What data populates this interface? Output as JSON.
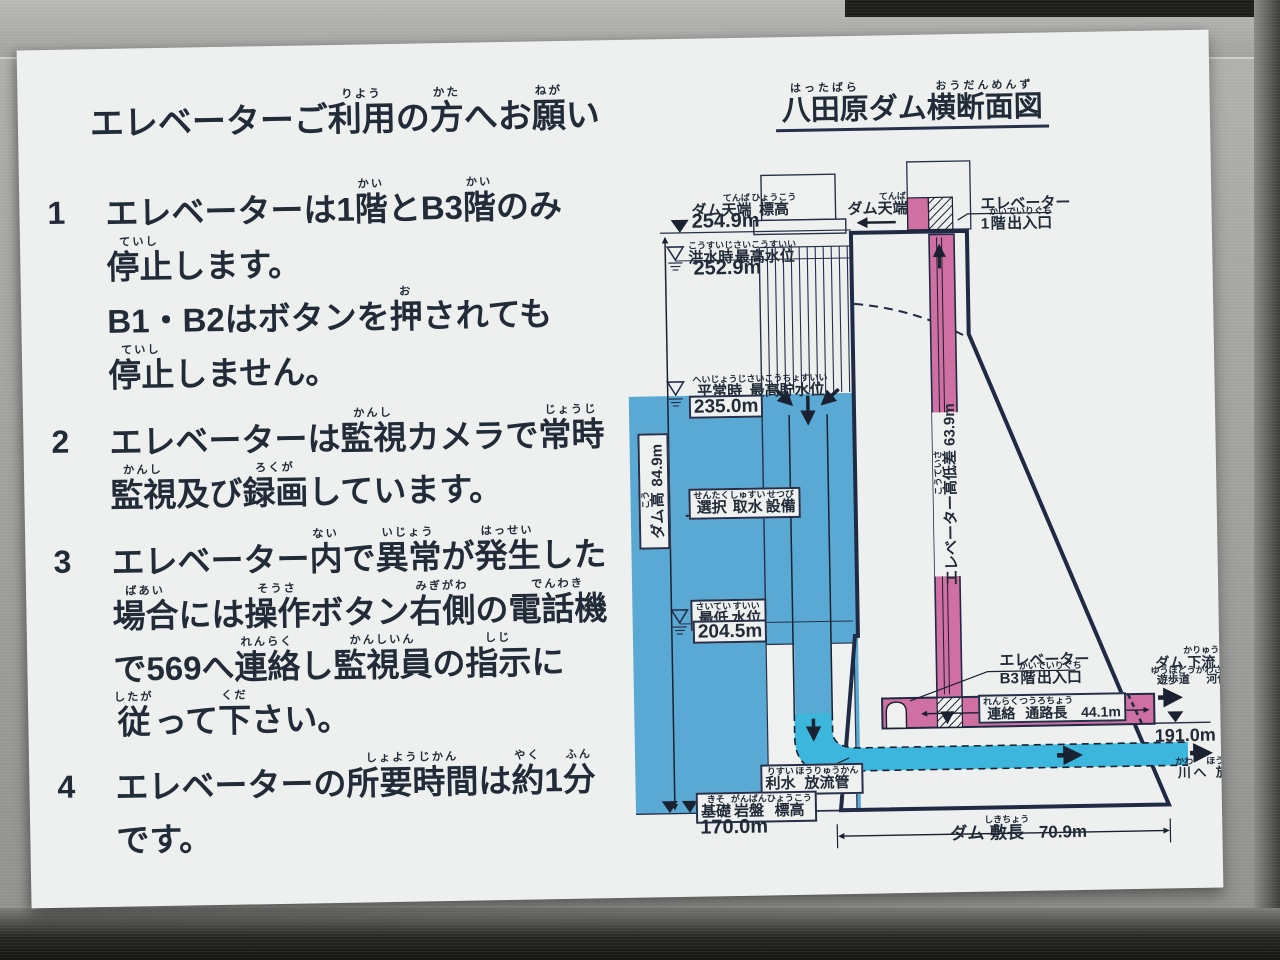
{
  "colors": {
    "water": "#5aa9d4",
    "pipe": "#3db6de",
    "pink": "#cf6fa2",
    "ink": "#222c38",
    "outline": "#1f2a45",
    "card": "#edf0ee"
  },
  "notice": {
    "title": [
      [
        "エレベーターご",
        ""
      ],
      [
        "利用",
        "りよう"
      ],
      [
        "の",
        ""
      ],
      [
        "方",
        "かた"
      ],
      [
        "へお",
        ""
      ],
      [
        "願",
        "ねが"
      ],
      [
        "い",
        ""
      ]
    ],
    "items": [
      {
        "num": "1",
        "lines": [
          [
            [
              "エレベーターは1",
              ""
            ],
            [
              "階",
              "かい"
            ],
            [
              "とB3",
              ""
            ],
            [
              "階",
              "かい"
            ],
            [
              "のみ",
              ""
            ]
          ],
          [
            [
              "停止",
              "ていし"
            ],
            [
              "します。",
              ""
            ]
          ],
          [
            [
              "B1・B2はボタンを",
              ""
            ],
            [
              "押",
              "お"
            ],
            [
              "されても",
              ""
            ]
          ],
          [
            [
              "停止",
              "ていし"
            ],
            [
              "しません。",
              ""
            ]
          ]
        ]
      },
      {
        "num": "2",
        "lines": [
          [
            [
              "エレベーターは",
              ""
            ],
            [
              "監視",
              "かんし"
            ],
            [
              "カメラで",
              ""
            ],
            [
              "常時",
              "じょうじ"
            ]
          ],
          [
            [
              "監視",
              "かんし"
            ],
            [
              "及び",
              ""
            ],
            [
              "録画",
              "ろくが"
            ],
            [
              "しています。",
              ""
            ]
          ]
        ]
      },
      {
        "num": "3",
        "lines": [
          [
            [
              "エレベーター",
              ""
            ],
            [
              "内",
              "ない"
            ],
            [
              "で",
              ""
            ],
            [
              "異常",
              "いじょう"
            ],
            [
              "が",
              ""
            ],
            [
              "発生",
              "はっせい"
            ],
            [
              "した",
              ""
            ]
          ],
          [
            [
              "場合",
              "ばあい"
            ],
            [
              "には",
              ""
            ],
            [
              "操作",
              "そうさ"
            ],
            [
              "ボタン",
              ""
            ],
            [
              "右側",
              "みぎがわ"
            ],
            [
              "の",
              ""
            ],
            [
              "電話機",
              "でんわき"
            ]
          ],
          [
            [
              "で569へ",
              ""
            ],
            [
              "連絡",
              "れんらく"
            ],
            [
              "し",
              ""
            ],
            [
              "監視員",
              "かんしいん"
            ],
            [
              "の",
              ""
            ],
            [
              "指示",
              "しじ"
            ],
            [
              "に",
              ""
            ]
          ],
          [
            [
              "従",
              "したが"
            ],
            [
              "って",
              ""
            ],
            [
              "下",
              "くだ"
            ],
            [
              "さい。",
              ""
            ]
          ]
        ]
      },
      {
        "num": "4",
        "lines": [
          [
            [
              "エレベーターの",
              ""
            ],
            [
              "所要時間",
              "しょようじかん"
            ],
            [
              "は",
              ""
            ],
            [
              "約",
              "やく"
            ],
            [
              "1",
              ""
            ],
            [
              "分",
              "ふん"
            ]
          ],
          [
            [
              "です。",
              ""
            ]
          ]
        ]
      }
    ]
  },
  "diagram": {
    "title": [
      [
        "八田原",
        "はったばら"
      ],
      [
        "ダム",
        ""
      ],
      [
        "横断面図",
        "おうだんめんず"
      ]
    ],
    "labels": {
      "crest_elev": [
        [
          "ダム",
          ""
        ],
        [
          "天端",
          "てんば"
        ],
        [
          "標高",
          "ひょうこう"
        ]
      ],
      "flood_level": [
        [
          "洪水時",
          "こうすいじ"
        ],
        [
          "最高水位",
          "さいこうすいい"
        ]
      ],
      "normal_level": [
        [
          "平常時",
          "へいじょうじ"
        ],
        [
          "最高貯水位",
          "さいこうちょすいい"
        ]
      ],
      "dam_height": [
        [
          "ダム",
          ""
        ],
        [
          "高",
          "こう"
        ],
        [
          " 84.9m",
          ""
        ]
      ],
      "intake": [
        [
          "選択",
          "せんたく"
        ],
        [
          "取水",
          "しゅすい"
        ],
        [
          "設備",
          "せつび"
        ]
      ],
      "min_level": [
        [
          "最低",
          "さいてい"
        ],
        [
          "水位",
          "すいい"
        ]
      ],
      "outlet_pipe": [
        [
          "利水",
          "りすい"
        ],
        [
          "放流管",
          "ほうりゅうかん"
        ]
      ],
      "foundation": [
        [
          "基礎",
          "きそ"
        ],
        [
          "岩盤",
          "がんばん"
        ],
        [
          "標高",
          "ひょうこう"
        ]
      ],
      "crest": [
        [
          "ダム",
          ""
        ],
        [
          "天端",
          "てんば"
        ]
      ],
      "elevator1": [
        [
          "エレベーター",
          ""
        ]
      ],
      "floor1": [
        [
          "1",
          ""
        ],
        [
          "階",
          "かい"
        ],
        [
          "出入口",
          "でいりぐち"
        ]
      ],
      "shaft": [
        [
          "エレベーター",
          ""
        ],
        [
          "高低差",
          "こうていさ"
        ],
        [
          " 63.9m",
          ""
        ]
      ],
      "elevator2": [
        [
          "エレベーター",
          ""
        ]
      ],
      "floorB3": [
        [
          "B3",
          ""
        ],
        [
          "階",
          "かい"
        ],
        [
          "出入口",
          "でいりぐち"
        ]
      ],
      "corridor": [
        [
          "連絡",
          "れんらく"
        ],
        [
          "通路長",
          "つうろちょう"
        ],
        [
          "  44.1m",
          ""
        ]
      ],
      "downstream": [
        [
          "ダム",
          ""
        ],
        [
          "下流",
          "かりゅう"
        ]
      ],
      "walkway": [
        [
          "遊歩道",
          "ゆうほどう"
        ],
        [
          "河佐峡",
          "かわさきょう"
        ],
        [
          "へ",
          ""
        ]
      ],
      "discharge": [
        [
          "川",
          "かわ"
        ],
        [
          "へ",
          ""
        ],
        [
          "放流",
          "ほうりゅう"
        ]
      ],
      "base_length": [
        [
          "ダム",
          ""
        ],
        [
          "敷長",
          "しきちょう"
        ],
        [
          "  70.9m",
          ""
        ]
      ]
    },
    "values": {
      "crest": "254.9m",
      "flood": "252.9m",
      "normal": "235.0m",
      "min": "204.5m",
      "foundation": "170.0m",
      "tailwater": "191.0m"
    }
  }
}
